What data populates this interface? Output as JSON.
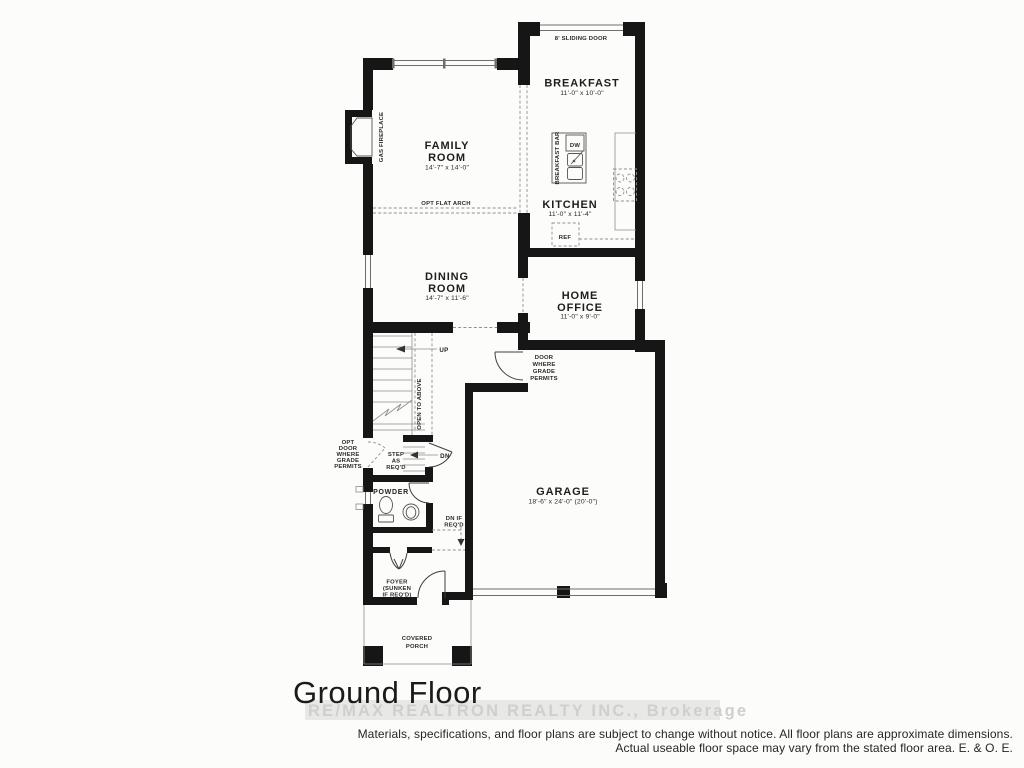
{
  "title": "Ground Floor",
  "watermark": "RE/MAX REALTRON REALTY INC., Brokerage",
  "disclaimer": {
    "line1": "Materials, specifications, and floor plans are subject to change without notice. All floor plans are approximate dimensions.",
    "line2": "Actual useable floor space may vary from the stated floor area. E. & O. E."
  },
  "rooms": {
    "family": {
      "name1": "FAMILY",
      "name2": "ROOM",
      "dims": "14'-7\" x 14'-0\""
    },
    "dining": {
      "name1": "DINING",
      "name2": "ROOM",
      "dims": "14'-7\" x 11'-6\""
    },
    "breakfast": {
      "name": "BREAKFAST",
      "dims": "11'-0\" x 10'-0\""
    },
    "kitchen": {
      "name": "KITCHEN",
      "dims": "11'-0\" x 11'-4\""
    },
    "home_office": {
      "name1": "HOME",
      "name2": "OFFICE",
      "dims": "11'-0\" x 9'-0\""
    },
    "garage": {
      "name": "GARAGE",
      "dims": "18'-6\" x 24'-0\" (20'-0\")"
    },
    "powder": {
      "name": "POWDER"
    },
    "foyer": {
      "line1": "FOYER",
      "line2": "(SUNKEN",
      "line3": "IF REQ'D)"
    },
    "porch": {
      "line1": "COVERED",
      "line2": "PORCH"
    }
  },
  "annotations": {
    "sliding_door": "8' SLIDING DOOR",
    "gas_fireplace": "GAS FIREPLACE",
    "opt_flat_arch": "OPT FLAT ARCH",
    "breakfast_bar": "BREAKFAST BAR",
    "open_to_above": "OPEN TO ABOVE",
    "dw": "DW",
    "ref": "REF",
    "up": "UP",
    "dn": "DN",
    "step1": "STEP",
    "step2": "AS",
    "step3": "REQ'D",
    "opt_door1": "OPT",
    "opt_door2": "DOOR",
    "opt_door3": "WHERE",
    "opt_door4": "GRADE",
    "opt_door5": "PERMITS",
    "grade_door1": "DOOR",
    "grade_door2": "WHERE",
    "grade_door3": "GRADE",
    "grade_door4": "PERMITS",
    "dn_if1": "DN IF",
    "dn_if2": "REQ'D"
  },
  "colors": {
    "wall": "#161616",
    "thin_line": "#6e6e6e",
    "dashed_line": "#8f8f8f",
    "watermark_band": "#e8e8e6",
    "watermark_text": "#cfcfcd"
  }
}
